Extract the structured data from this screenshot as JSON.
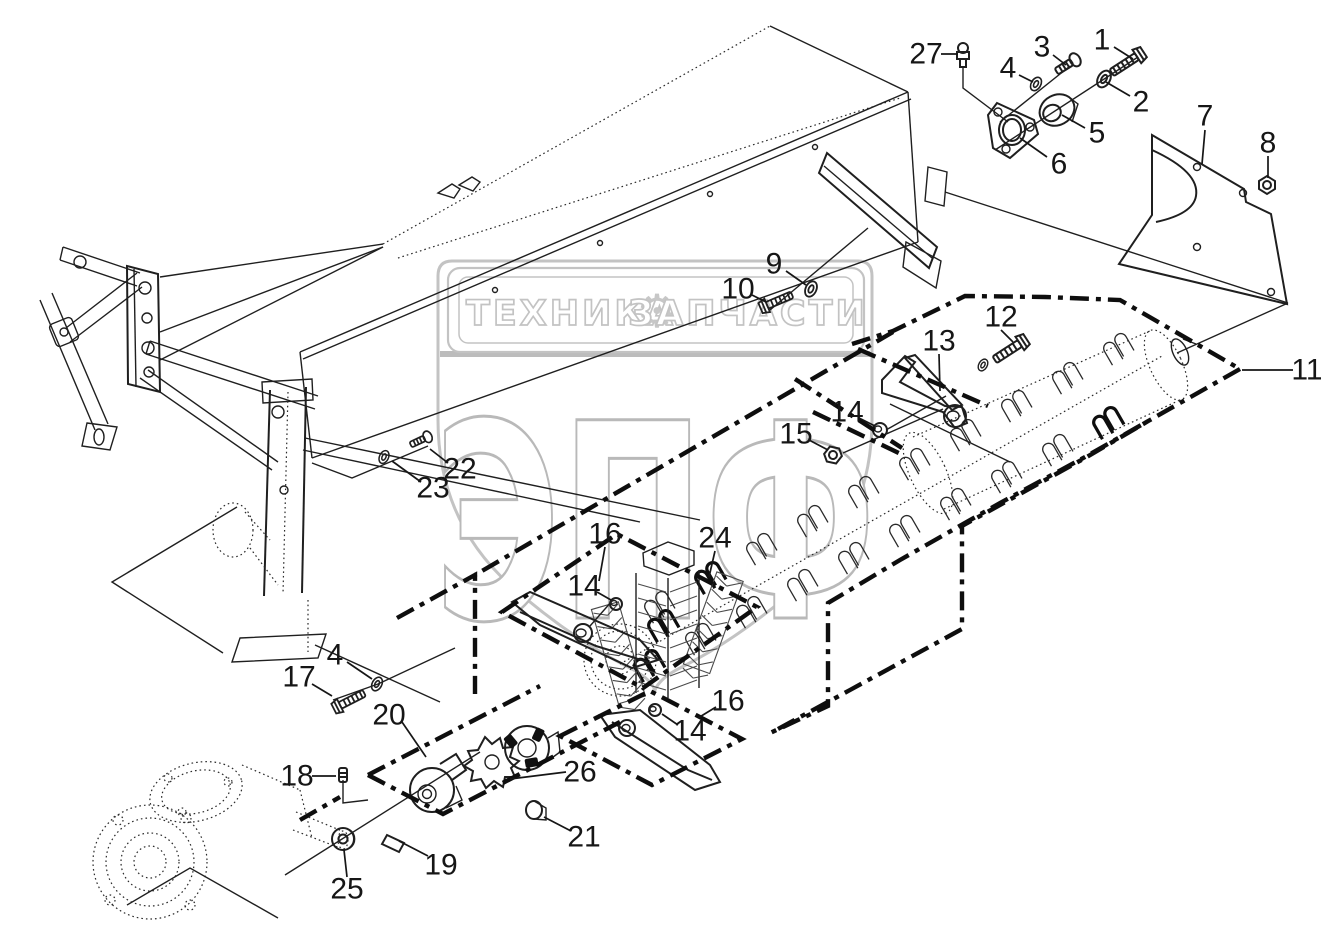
{
  "canvas": {
    "width": 1321,
    "height": 928,
    "background": "#ffffff",
    "line_color": "#1f1f1f",
    "bold_boundary_color": "#0e0e0e",
    "watermark_color": "#c3c3c3"
  },
  "watermark": {
    "band_left_text": "ТЕХНИКА",
    "band_right_text": "ЗАПЧАСТИ",
    "gear_icon": "⚙",
    "monogram": "ЭПФ"
  },
  "callouts": [
    {
      "id": "part-1",
      "label": "1",
      "x": 1102,
      "y": 40,
      "leader": [
        [
          1114,
          47
        ],
        [
          1133,
          59
        ]
      ]
    },
    {
      "id": "part-2",
      "label": "2",
      "x": 1141,
      "y": 102,
      "leader": [
        [
          1130,
          96
        ],
        [
          1106,
          82
        ]
      ]
    },
    {
      "id": "part-3",
      "label": "3",
      "x": 1042,
      "y": 47,
      "leader": [
        [
          1053,
          55
        ],
        [
          1066,
          65
        ]
      ]
    },
    {
      "id": "part-4-upper",
      "label": "4",
      "x": 1008,
      "y": 68,
      "leader": [
        [
          1019,
          75
        ],
        [
          1033,
          82
        ]
      ]
    },
    {
      "id": "part-5",
      "label": "5",
      "x": 1097,
      "y": 133,
      "leader": [
        [
          1085,
          128
        ],
        [
          1062,
          115
        ]
      ]
    },
    {
      "id": "part-6",
      "label": "6",
      "x": 1059,
      "y": 164,
      "leader": [
        [
          1047,
          157
        ],
        [
          1020,
          138
        ]
      ]
    },
    {
      "id": "part-7",
      "label": "7",
      "x": 1205,
      "y": 116,
      "leader": [
        [
          1205,
          130
        ],
        [
          1202,
          164
        ]
      ]
    },
    {
      "id": "part-8",
      "label": "8",
      "x": 1268,
      "y": 143,
      "leader": [
        [
          1268,
          156
        ],
        [
          1268,
          178
        ]
      ]
    },
    {
      "id": "part-9",
      "label": "9",
      "x": 774,
      "y": 264,
      "leader": [
        [
          786,
          271
        ],
        [
          806,
          285
        ]
      ]
    },
    {
      "id": "part-10",
      "label": "10",
      "x": 738,
      "y": 289,
      "leader": [
        [
          752,
          295
        ],
        [
          766,
          302
        ]
      ]
    },
    {
      "id": "part-11",
      "label": "11",
      "x": 1307,
      "y": 370,
      "leader": [
        [
          1293,
          370
        ],
        [
          1242,
          370
        ]
      ]
    },
    {
      "id": "part-12",
      "label": "12",
      "x": 1001,
      "y": 317,
      "leader": [
        [
          1001,
          330
        ],
        [
          1013,
          342
        ]
      ]
    },
    {
      "id": "part-13",
      "label": "13",
      "x": 939,
      "y": 341,
      "leader": [
        [
          939,
          354
        ],
        [
          940,
          391
        ]
      ]
    },
    {
      "id": "part-14-top",
      "label": "14",
      "x": 847,
      "y": 412,
      "leader": [
        [
          859,
          418
        ],
        [
          875,
          426
        ]
      ]
    },
    {
      "id": "part-15",
      "label": "15",
      "x": 796,
      "y": 434,
      "leader": [
        [
          809,
          440
        ],
        [
          828,
          450
        ]
      ]
    },
    {
      "id": "part-16-middle",
      "label": "16",
      "x": 605,
      "y": 534,
      "leader": [
        [
          605,
          547
        ],
        [
          599,
          581
        ]
      ]
    },
    {
      "id": "part-24",
      "label": "24",
      "x": 715,
      "y": 538,
      "leader": [
        [
          715,
          551
        ],
        [
          709,
          577
        ]
      ]
    },
    {
      "id": "part-14-middle",
      "label": "14",
      "x": 584,
      "y": 586,
      "leader": [
        [
          597,
          592
        ],
        [
          611,
          600
        ]
      ]
    },
    {
      "id": "part-22",
      "label": "22",
      "x": 460,
      "y": 469,
      "leader": [
        [
          448,
          463
        ],
        [
          430,
          449
        ]
      ]
    },
    {
      "id": "part-23",
      "label": "23",
      "x": 433,
      "y": 488,
      "leader": [
        [
          421,
          482
        ],
        [
          392,
          461
        ]
      ]
    },
    {
      "id": "part-4-lower",
      "label": "4",
      "x": 335,
      "y": 655,
      "leader": [
        [
          347,
          662
        ],
        [
          372,
          679
        ]
      ]
    },
    {
      "id": "part-17",
      "label": "17",
      "x": 299,
      "y": 677,
      "leader": [
        [
          312,
          684
        ],
        [
          332,
          696
        ]
      ]
    },
    {
      "id": "part-20",
      "label": "20",
      "x": 389,
      "y": 715,
      "leader": [
        [
          402,
          722
        ],
        [
          426,
          757
        ]
      ]
    },
    {
      "id": "part-18",
      "label": "18",
      "x": 297,
      "y": 776,
      "leader": [
        [
          312,
          776
        ],
        [
          336,
          776
        ]
      ]
    },
    {
      "id": "part-26",
      "label": "26",
      "x": 580,
      "y": 772,
      "leader": [
        [
          566,
          772
        ],
        [
          510,
          779
        ]
      ]
    },
    {
      "id": "part-16-bottom",
      "label": "16",
      "x": 728,
      "y": 701,
      "leader": [
        [
          716,
          707
        ],
        [
          698,
          718
        ]
      ]
    },
    {
      "id": "part-14-bottom",
      "label": "14",
      "x": 690,
      "y": 731,
      "leader": [
        [
          678,
          725
        ],
        [
          662,
          714
        ]
      ]
    },
    {
      "id": "part-21",
      "label": "21",
      "x": 584,
      "y": 837,
      "leader": [
        [
          571,
          831
        ],
        [
          544,
          817
        ]
      ]
    },
    {
      "id": "part-19",
      "label": "19",
      "x": 441,
      "y": 865,
      "leader": [
        [
          428,
          856
        ],
        [
          399,
          841
        ]
      ]
    },
    {
      "id": "part-25",
      "label": "25",
      "x": 347,
      "y": 889,
      "leader": [
        [
          347,
          877
        ],
        [
          344,
          850
        ]
      ]
    },
    {
      "id": "part-27",
      "label": "27",
      "x": 926,
      "y": 54,
      "leader": [
        [
          941,
          54
        ],
        [
          958,
          54
        ]
      ]
    }
  ]
}
